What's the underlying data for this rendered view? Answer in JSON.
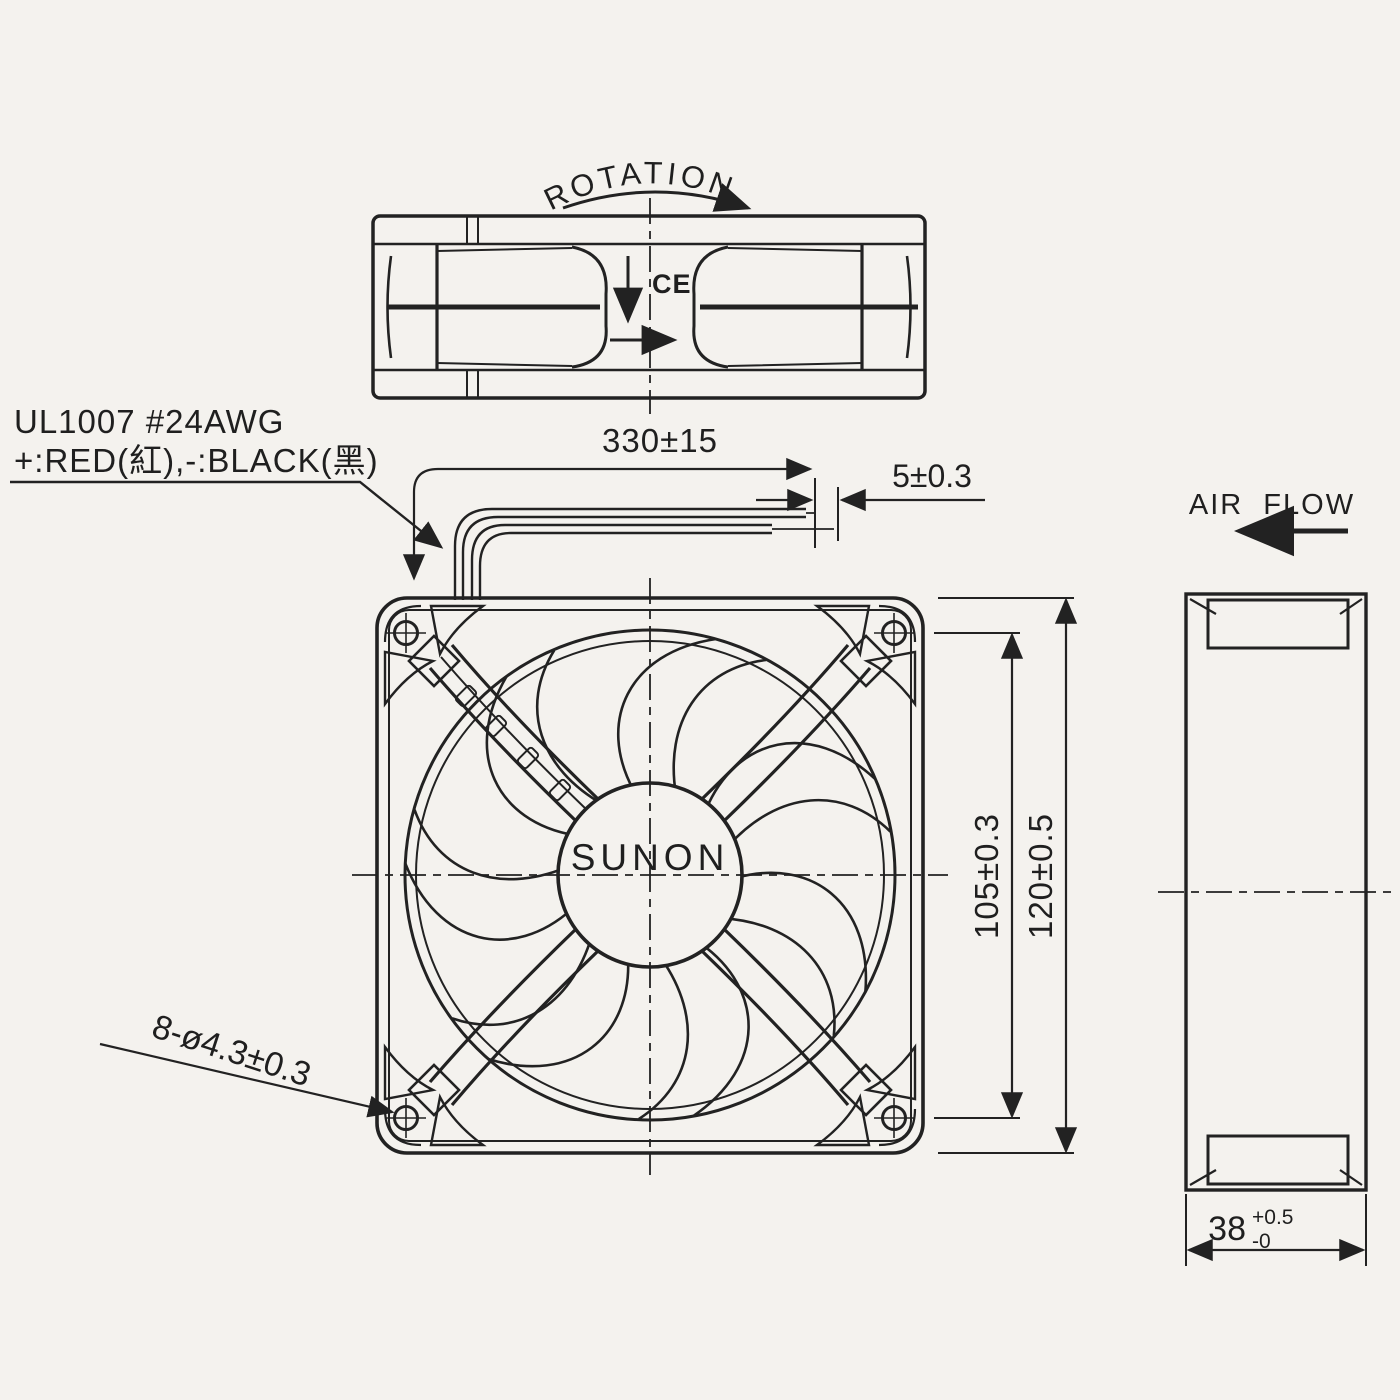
{
  "labels": {
    "rotation": "ROTATION",
    "air_flow": "AIR FLOW",
    "brand": "SUNON",
    "ce": "CE",
    "wire_spec": "UL1007 #24AWG",
    "wire_colors": "+:RED(紅),-:BLACK(黑)"
  },
  "dimensions": {
    "lead_length": "330±15",
    "tinning_length": "5±0.3",
    "mounting_hole_pitch": "105±0.3",
    "frame_width": "120±0.5",
    "mounting_holes": "8-ø4.3±0.3",
    "depth": "38",
    "depth_tol_upper": "+0.5",
    "depth_tol_lower": "-0"
  },
  "colors": {
    "background": "#f4f2ee",
    "ink": "#222222"
  }
}
